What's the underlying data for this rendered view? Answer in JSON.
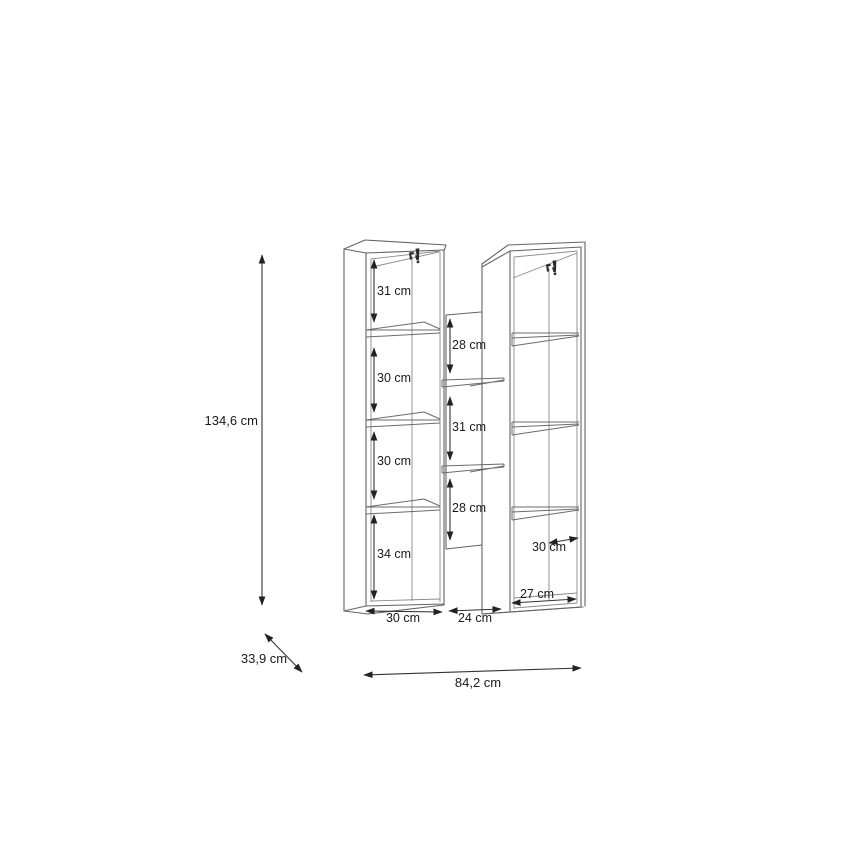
{
  "page": {
    "background": "#ffffff"
  },
  "colors": {
    "furniture_line": "#636363",
    "inner_line": "#8a8a8a",
    "dimension_line": "#333333",
    "label_text": "#1a1a1a",
    "bracket_fill": "#2b2b2b"
  },
  "icons": {
    "left_bracket": "wall-mount-bracket-icon",
    "right_bracket": "wall-mount-bracket-icon"
  },
  "labels": {
    "total_height": "134,6 cm",
    "total_depth": "33,9 cm",
    "total_width": "84,2 cm",
    "left_unit": {
      "compartments": [
        "31 cm",
        "30 cm",
        "30 cm",
        "34 cm"
      ],
      "bottom_width": "30 cm"
    },
    "middle_section": {
      "compartments": [
        "28 cm",
        "31 cm",
        "28 cm"
      ],
      "bottom_width": "24 cm"
    },
    "right_unit": {
      "inner_width": "30 cm",
      "bottom_width": "27 cm"
    }
  }
}
